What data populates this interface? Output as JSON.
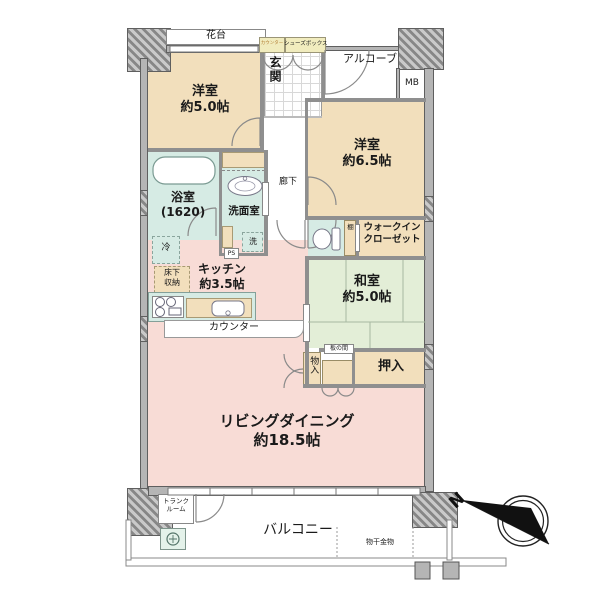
{
  "colors": {
    "room_beige": "#f2dfbc",
    "room_pink": "#f8dcd6",
    "tatami_green": "#e3eed7",
    "wet_blue": "#d6ebe4",
    "box_yellow": "#f1ecbe",
    "wall_gray": "#b5b5b5",
    "outline_dark": "#5f5f5f"
  },
  "plan": {
    "exterior": {
      "hanadai": "花台",
      "alcove": "アルコーブ",
      "mb": "MB",
      "balcony": "バルコニー",
      "monohoshi": "物干金物",
      "trunk_line1": "トランク",
      "trunk_line2": "ルーム",
      "north": "N"
    },
    "entry": {
      "genkan": "玄関",
      "shoebox_counter": "カウンター",
      "shoebox": "シューズボックス",
      "hallway": "廊下"
    },
    "rooms": {
      "western1_name": "洋室",
      "western1_size": "約5.0帖",
      "western2_name": "洋室",
      "western2_size": "約6.5帖",
      "japanese_name": "和室",
      "japanese_size": "約5.0帖",
      "living_name": "リビングダイニング",
      "living_size": "約18.5帖",
      "kitchen_name": "キッチン",
      "kitchen_size": "約3.5帖"
    },
    "wet": {
      "bath_name": "浴室",
      "bath_size": "(1620)",
      "washroom": "洗面室",
      "laundry": "洗",
      "ps": "PS",
      "fridge": "冷"
    },
    "storage": {
      "wic_line1": "ウォークイン",
      "wic_line2": "クローゼット",
      "oshiire": "押入",
      "monoire": "物入",
      "itanoma": "板の間",
      "tana": "棚",
      "yukashita_line1": "床下",
      "yukashita_line2": "収納",
      "counter": "カウンター"
    }
  }
}
